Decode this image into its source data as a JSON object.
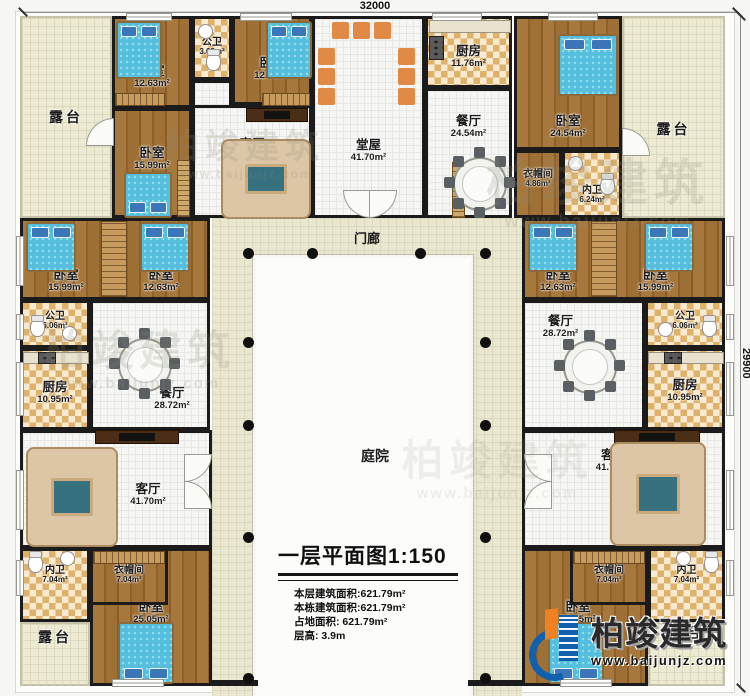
{
  "plan": {
    "dim_top": "32000",
    "dim_right": "29900",
    "porch": "门廊",
    "courtyard": "庭院"
  },
  "rooms": {
    "terrace_tl": {
      "name": "露台",
      "area": ""
    },
    "bedroom_a": {
      "name": "卧室",
      "area": "12.63m²"
    },
    "bath_top": {
      "name": "公卫",
      "area": "3.68m²"
    },
    "bedroom_b": {
      "name": "卧室",
      "area": "12.63m²"
    },
    "living_tl": {
      "name": "客厅",
      "area": "24.56m²"
    },
    "bedroom_c": {
      "name": "卧室",
      "area": "15.99m²"
    },
    "hall": {
      "name": "堂屋",
      "area": "41.70m²"
    },
    "kitchen_top": {
      "name": "厨房",
      "area": "11.76m²"
    },
    "dining_top": {
      "name": "餐厅",
      "area": "24.54m²"
    },
    "bedroom_d": {
      "name": "卧室",
      "area": "24.54m²"
    },
    "cloak_top": {
      "name": "衣帽间",
      "area": "4.86m²"
    },
    "bath_d": {
      "name": "内卫",
      "area": "6.24m²"
    },
    "terrace_tr": {
      "name": "露台",
      "area": ""
    },
    "bedroom_e": {
      "name": "卧室",
      "area": "15.99m²"
    },
    "bedroom_f": {
      "name": "卧室",
      "area": "12.63m²"
    },
    "bedroom_g": {
      "name": "卧室",
      "area": "12.63m²"
    },
    "bedroom_h": {
      "name": "卧室",
      "area": "15.99m²"
    },
    "bath_left": {
      "name": "公卫",
      "area": "6.06m²"
    },
    "kitchen_left": {
      "name": "厨房",
      "area": "10.95m²"
    },
    "dining_left": {
      "name": "餐厅",
      "area": "28.72m²"
    },
    "dining_right": {
      "name": "餐厅",
      "area": "28.72m²"
    },
    "bath_right": {
      "name": "公卫",
      "area": "6.06m²"
    },
    "kitchen_right": {
      "name": "厨房",
      "area": "10.95m²"
    },
    "living_bl": {
      "name": "客厅",
      "area": "41.70m²"
    },
    "bath_bl": {
      "name": "内卫",
      "area": "7.04m²"
    },
    "cloak_bl": {
      "name": "衣帽间",
      "area": "7.04m²"
    },
    "bedroom_bl": {
      "name": "卧室",
      "area": "25.05m²"
    },
    "terrace_bl": {
      "name": "露台",
      "area": ""
    },
    "living_br": {
      "name": "客厅",
      "area": "41.70m²"
    },
    "cloak_br": {
      "name": "衣帽间",
      "area": "7.04m²"
    },
    "bath_br": {
      "name": "内卫",
      "area": "7.04m²"
    },
    "bedroom_br": {
      "name": "卧室",
      "area": "25.05m²"
    },
    "terrace_br": {
      "name": "露台",
      "area": ""
    }
  },
  "title_block": {
    "title": "一层平面图",
    "scale": "1:150",
    "line1": "本层建筑面积:621.79m²",
    "line2": "本栋建筑面积:621.79m²",
    "line3": "占地面积: 621.79m²",
    "line4": "层高: 3.9m"
  },
  "brand": {
    "name": "柏竣建筑",
    "site": "www.baijunjz.com"
  },
  "colors": {
    "wall": "#1b1b1b",
    "wood": "#9a6b33",
    "terrace": "#edead4",
    "tile": "#dfb26c",
    "bed": "#55bedd",
    "logo_blue": "#1160ae",
    "logo_orange": "#ef8122"
  }
}
